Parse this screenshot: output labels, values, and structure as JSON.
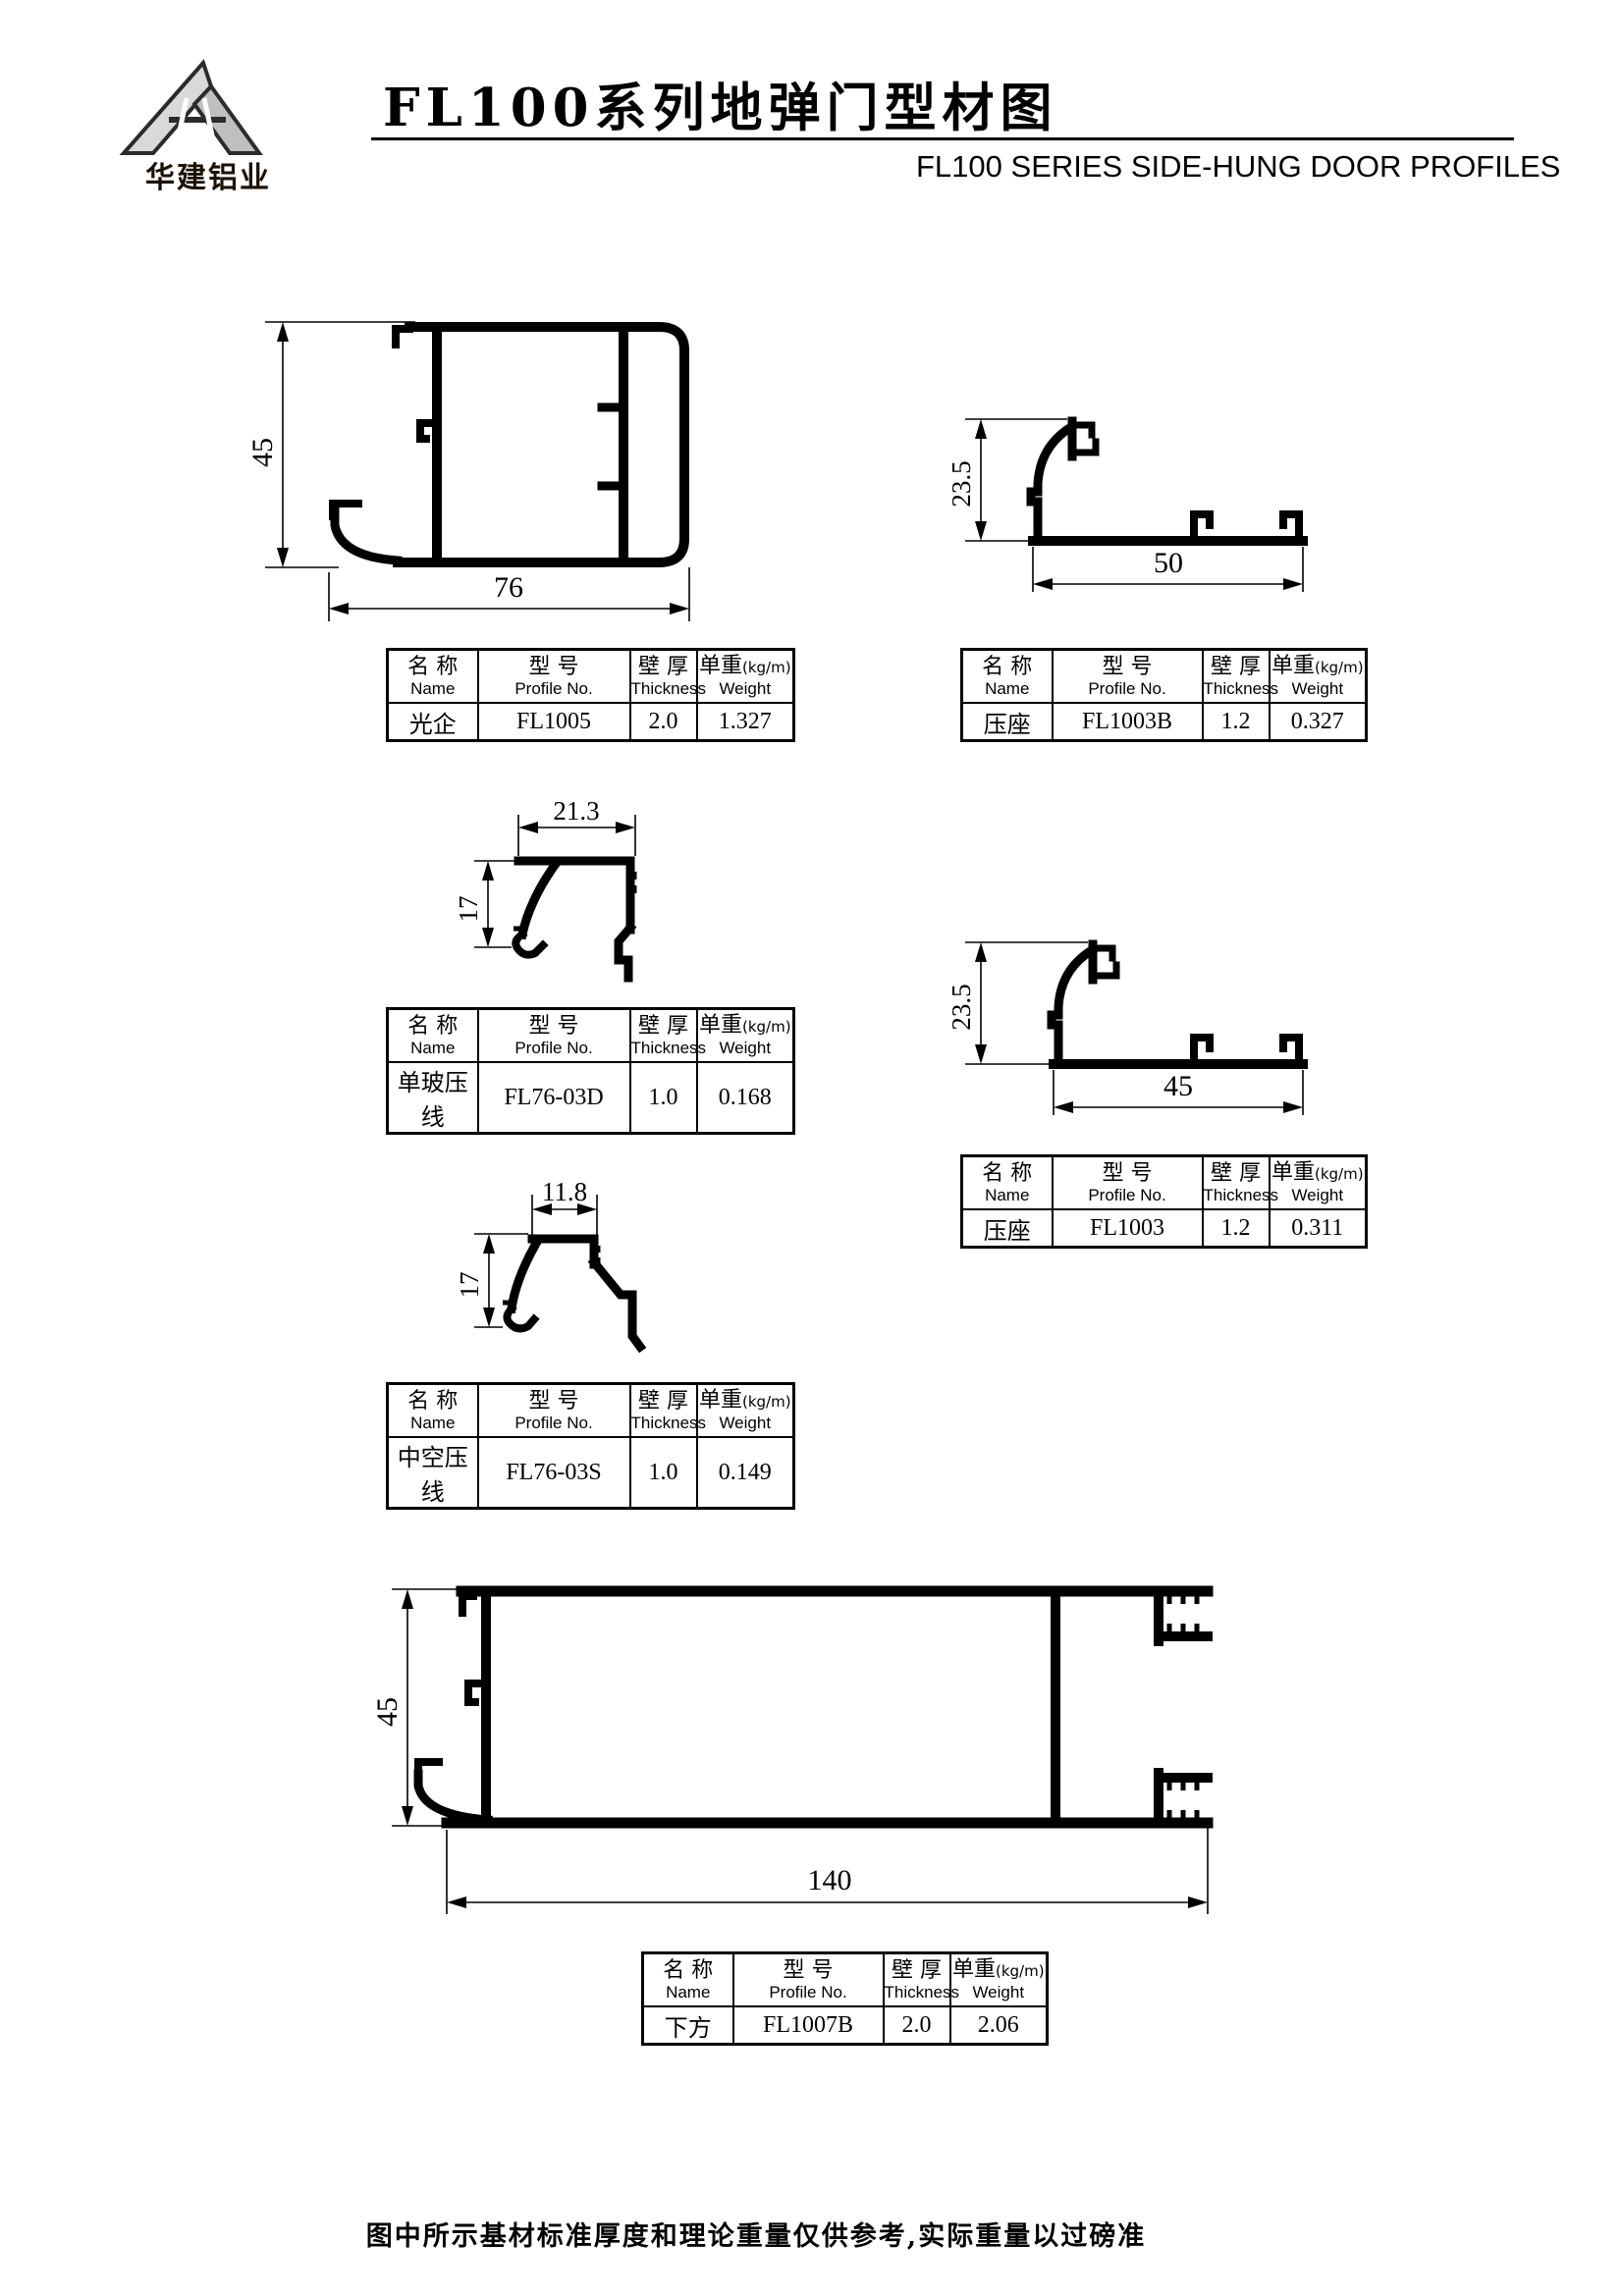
{
  "page": {
    "background": "#ffffff",
    "ink": "#000000"
  },
  "header": {
    "brand_text": "华建铝业",
    "title_zh": "FL100系列地弹门型材图",
    "subtitle_en": "FL100 SERIES SIDE-HUNG DOOR PROFILES"
  },
  "table_headers": {
    "name_zh": "名 称",
    "name_en": "Name",
    "profile_zh": "型 号",
    "profile_en": "Profile No.",
    "thickness_zh": "壁 厚",
    "thickness_en": "Thickness",
    "weight_zh": "单重",
    "weight_unit": "(kg/m)",
    "weight_en": "Weight"
  },
  "profiles": [
    {
      "name": "光企",
      "profile_no": "FL1005",
      "thickness": "2.0",
      "weight": "1.327",
      "dim_height": "45",
      "dim_width": "76"
    },
    {
      "name": "压座",
      "profile_no": "FL1003B",
      "thickness": "1.2",
      "weight": "0.327",
      "dim_height": "23.5",
      "dim_width": "50"
    },
    {
      "name": "单玻压线",
      "profile_no": "FL76-03D",
      "thickness": "1.0",
      "weight": "0.168",
      "dim_height": "17",
      "dim_width": "21.3"
    },
    {
      "name": "压座",
      "profile_no": "FL1003",
      "thickness": "1.2",
      "weight": "0.311",
      "dim_height": "23.5",
      "dim_width": "45"
    },
    {
      "name": "中空压线",
      "profile_no": "FL76-03S",
      "thickness": "1.0",
      "weight": "0.149",
      "dim_height": "17",
      "dim_width": "11.8"
    },
    {
      "name": "下方",
      "profile_no": "FL1007B",
      "thickness": "2.0",
      "weight": "2.06",
      "dim_height": "45",
      "dim_width": "140"
    }
  ],
  "footer": {
    "note": "图中所示基材标准厚度和理论重量仅供参考,实际重量以过磅准"
  }
}
